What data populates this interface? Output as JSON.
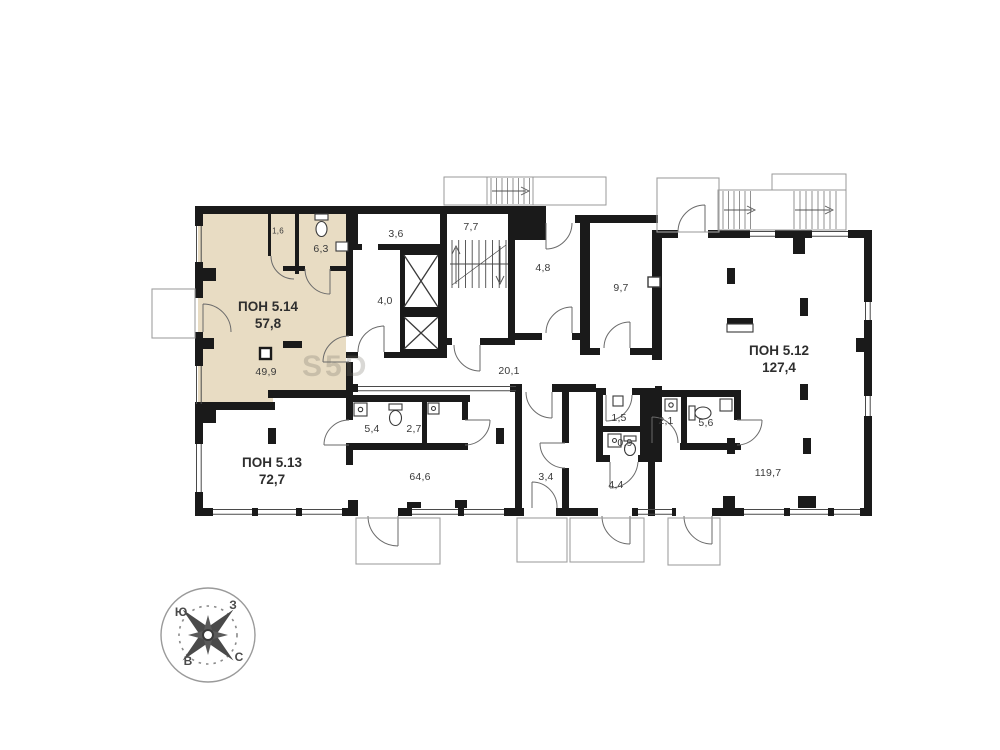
{
  "watermark": "S5D",
  "colors": {
    "highlight": "#e8dcc3",
    "wall": "#1a1a1a"
  },
  "units": [
    {
      "name": "ПОН 5.14",
      "area": "57,8"
    },
    {
      "name": "ПОН 5.13",
      "area": "72,7"
    },
    {
      "name": "ПОН 5.12",
      "area": "127,4"
    }
  ],
  "rooms": [
    {
      "label": "1,6"
    },
    {
      "label": "6,3"
    },
    {
      "label": "3,6"
    },
    {
      "label": "7,7"
    },
    {
      "label": "4,0"
    },
    {
      "label": "4,8"
    },
    {
      "label": "9,7"
    },
    {
      "label": "20,1"
    },
    {
      "label": "49,9"
    },
    {
      "label": "5,4"
    },
    {
      "label": "2,7"
    },
    {
      "label": "64,6"
    },
    {
      "label": "3,4"
    },
    {
      "label": "1,5"
    },
    {
      "label": "0,9"
    },
    {
      "label": "2,1"
    },
    {
      "label": "5,6"
    },
    {
      "label": "4,4"
    },
    {
      "label": "119,7"
    }
  ],
  "compass": {
    "top_left": "Ю",
    "top_right": "З",
    "bottom_left": "В",
    "bottom_right": "С"
  }
}
